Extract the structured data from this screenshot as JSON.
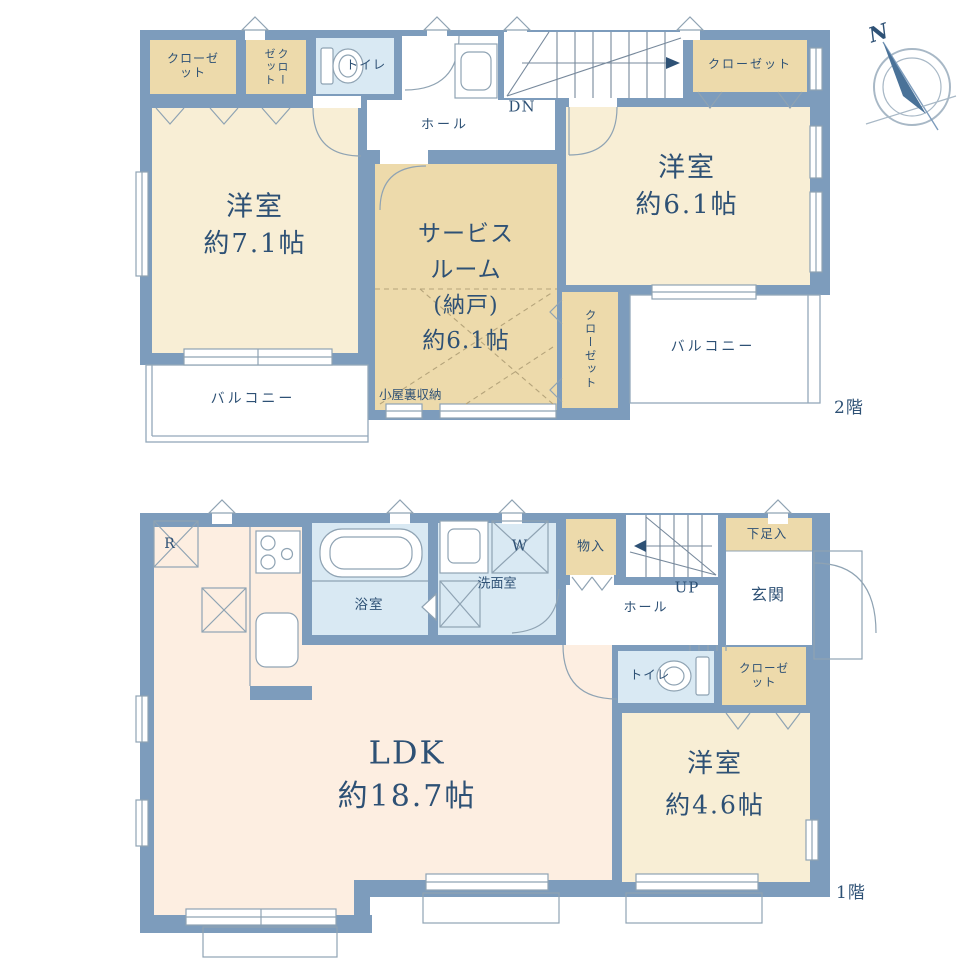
{
  "palette": {
    "wall": "#7d9cbc",
    "room_cream": "#f8eed5",
    "room_tan": "#eddaab",
    "room_blue": "#d9e9f3",
    "room_pink": "#fdeee1",
    "line": "#8fa3b3",
    "text": "#2e5175"
  },
  "compass": {
    "label": "N"
  },
  "icons": [
    "compass-icon",
    "toilet-icon",
    "bathtub-icon",
    "washbasin-icon",
    "stove-icon",
    "sink-icon",
    "fridge-box-icon",
    "counter-box-icon",
    "washer-box-icon",
    "stairs-down-icon",
    "stairs-up-icon",
    "door-arc-icon",
    "closet-door-icon",
    "vent-icon"
  ],
  "floor2": {
    "floor_label": "2階",
    "closet_a": "クローゼット",
    "closet_b": "クローゼット",
    "closet_c": "クローゼット",
    "closet_d": "クローゼット",
    "toilet": "トイレ",
    "hall": "ホール",
    "stairs_label": "DN",
    "bedroom_left": {
      "name": "洋室",
      "size": "約7.1帖"
    },
    "bedroom_right": {
      "name": "洋室",
      "size": "約6.1帖"
    },
    "service_room": {
      "name1": "サービス",
      "name2": "ルーム",
      "name3": "(納戸)",
      "size": "約6.1帖"
    },
    "attic_note": "小屋裏収納",
    "balcony_left": "バルコニー",
    "balcony_right": "バルコニー"
  },
  "floor1": {
    "floor_label": "1階",
    "fridge_label": "R",
    "bath": "浴室",
    "washer_label": "W",
    "washroom": "洗面室",
    "storage": "物入",
    "stairs_label": "UP",
    "hall": "ホール",
    "shoe_storage": "下足入",
    "entrance": "玄関",
    "toilet": "トイレ",
    "closet": "クローゼット",
    "ldk": {
      "name": "LDK",
      "size": "約18.7帖"
    },
    "bedroom": {
      "name": "洋室",
      "size": "約4.6帖"
    }
  }
}
